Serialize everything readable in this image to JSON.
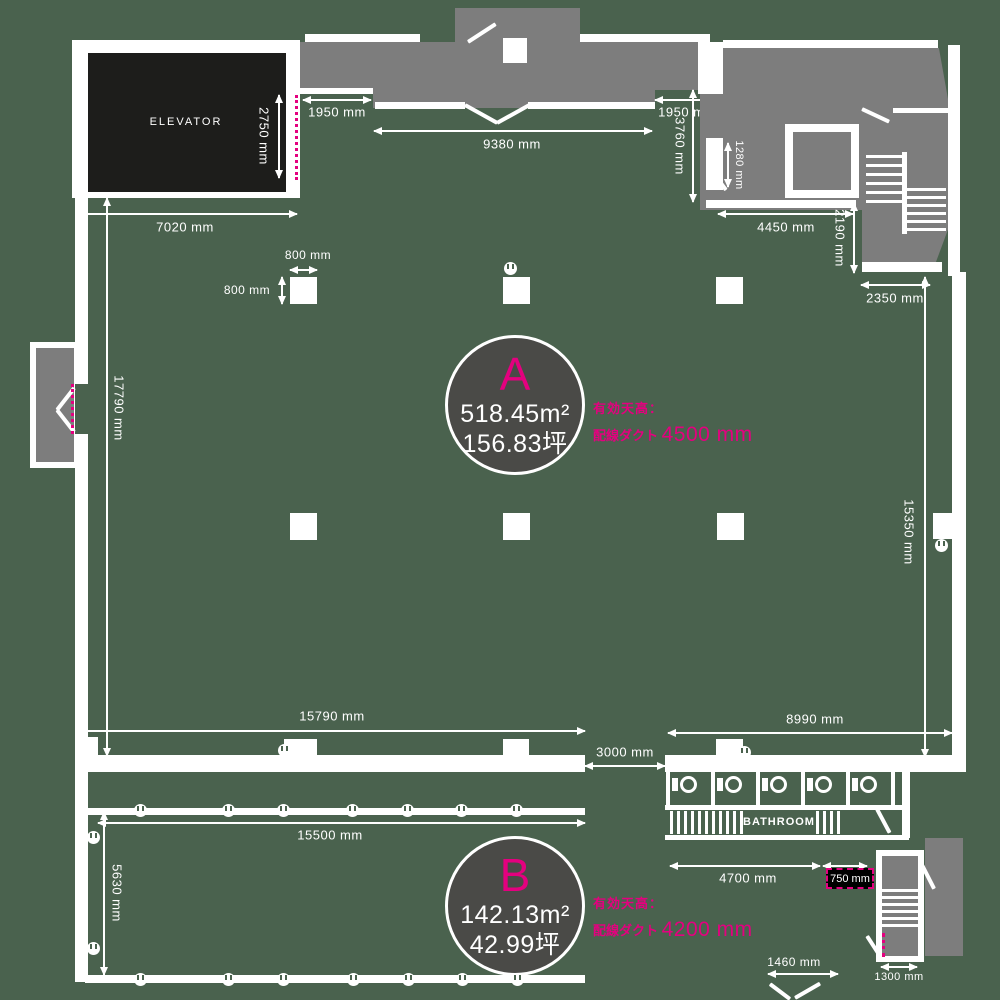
{
  "colors": {
    "background": "#4a624e",
    "structure": "#7d7d7d",
    "wall": "#ffffff",
    "elevator_fill": "#1d1d1b",
    "accent": "#e4007f",
    "zone_fill": "#4a4a47"
  },
  "labels": {
    "elevator": "ELEVATOR",
    "bathroom": "BATHROOM"
  },
  "zone_a": {
    "id": "A",
    "area": "518.45m²",
    "tsubo": "156.83坪",
    "note_title": "有効天高：",
    "note_prefix": "配線ダクト ",
    "note_value": "4500 mm"
  },
  "zone_b": {
    "id": "B",
    "area": "142.13m²",
    "tsubo": "42.99坪",
    "note_title": "有効天高：",
    "note_prefix": "配線ダクト ",
    "note_value": "4200 mm"
  },
  "dims": {
    "elevator_depth": "2750 mm",
    "elevator_width": "7020 mm",
    "entry_left": "1950 mm",
    "corridor_width": "9380 mm",
    "entry_right": "1950 mm",
    "right_depth": "3760 mm",
    "shaft_door": "1280 mm",
    "topright_width": "4450 mm",
    "stair_width": "2190 mm",
    "stair_east": "2350 mm",
    "pillar_width": "800 mm",
    "pillar_depth": "800 mm",
    "a_left_depth": "17790 mm",
    "a_right_depth": "15350 mm",
    "a_width": "15790 mm",
    "a_right_width": "8990 mm",
    "passage": "3000 mm",
    "b_width": "15500 mm",
    "b_depth": "5630 mm",
    "bath_width": "4700 mm",
    "service_elevator": "750 mm",
    "b_entry": "1460 mm",
    "stair_south": "1300 mm"
  }
}
